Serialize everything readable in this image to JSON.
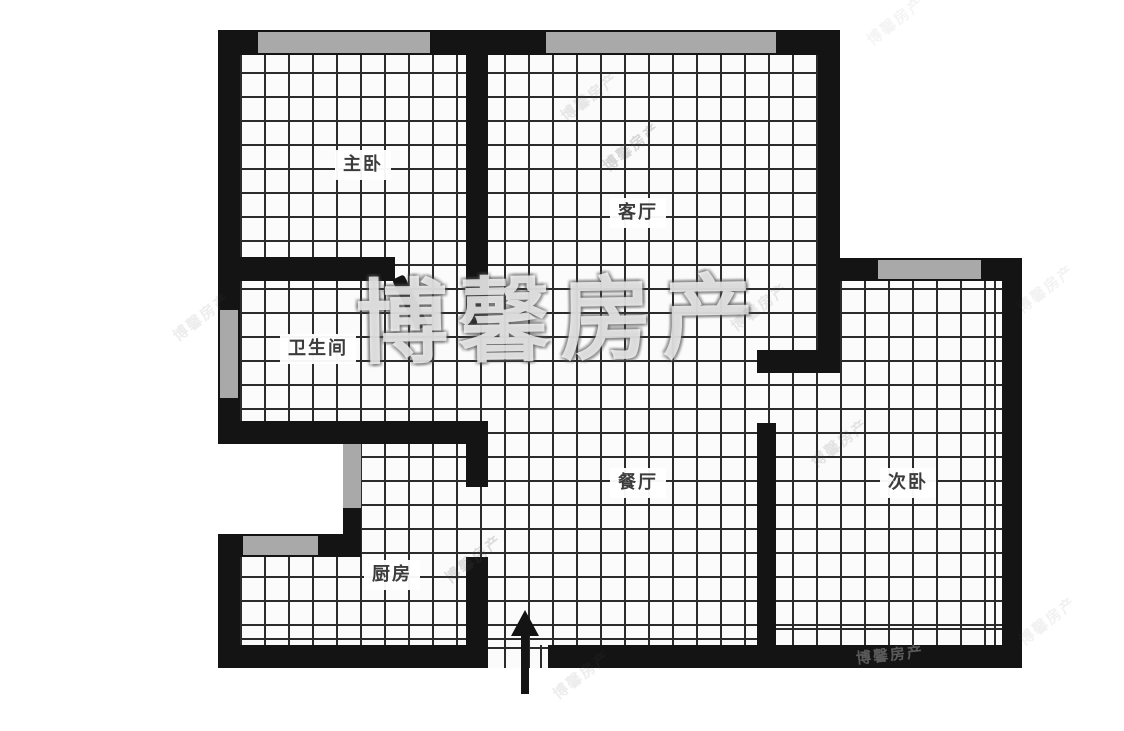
{
  "plan": {
    "type": "apartment-floor-plan",
    "rooms": [
      {
        "id": "master-bedroom",
        "label": "主卧"
      },
      {
        "id": "living-room",
        "label": "客厅"
      },
      {
        "id": "bathroom",
        "label": "卫生间"
      },
      {
        "id": "dining-room",
        "label": "餐厅"
      },
      {
        "id": "second-bedroom",
        "label": "次卧"
      },
      {
        "id": "kitchen",
        "label": "厨房"
      }
    ],
    "entrance": {
      "symbol": "up-arrow",
      "meaning": "entry direction"
    }
  },
  "watermarks": {
    "large_text": "博馨房产",
    "small_text": "博馨房产"
  },
  "colors": {
    "wall": "#141414",
    "window": "#a9a9a9",
    "grid_line": "#2b2b2b",
    "floor": "#fbfbfb",
    "background": "#ffffff",
    "label_text": "#3c3c3c"
  }
}
